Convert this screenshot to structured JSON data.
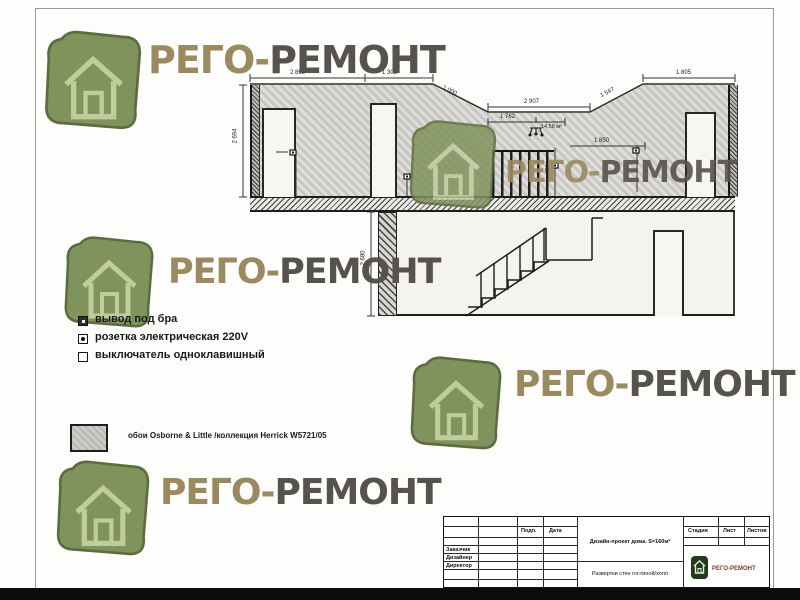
{
  "watermark": {
    "part1": "РЕГО-",
    "part2": "РЕМОНТ"
  },
  "colors": {
    "logo_green": "#81935d",
    "logo_outline": "#5c6c3e",
    "house_stroke": "#bfcc9e",
    "watermark_tan": "#9b8a60",
    "watermark_dark": "#56524c",
    "brand_brown": "#7a3f1f",
    "wall_gray": "#d3d1cc"
  },
  "legend": {
    "items": [
      {
        "symbol": "sconce-outlet",
        "label": "вывод под бра"
      },
      {
        "symbol": "power-socket",
        "label": "розетка электрическая 220V"
      },
      {
        "symbol": "single-switch",
        "label": "выключатель одноклавишный"
      }
    ]
  },
  "material": {
    "label": "обои Osborne & Little /коллекция Herrick W5721/05"
  },
  "dims": {
    "top_a": "2 895",
    "top_b": "1 302",
    "diag_left": "1 000",
    "mid_top": "2 907",
    "mid_sub": "1 762",
    "right_leader": "1 850",
    "diag_right": "1 547",
    "top_right": "1 805",
    "height_upper": "2 694",
    "height_lower": "2 680",
    "socket_height": "750",
    "area": "14,58 м²"
  },
  "titleblock": {
    "col_sign": "Подп.",
    "col_date": "Дата",
    "rows": [
      "Заказчик",
      "Дизайнер",
      "Директор"
    ],
    "project": "Дизайн-проект дома.  S=160м²",
    "sheet_title": "Развертки стен гостиной/холл",
    "stage": "Стадия",
    "sheet": "Лист",
    "sheets": "Листов",
    "brand": "РЕГО-РЕМОНТ"
  }
}
